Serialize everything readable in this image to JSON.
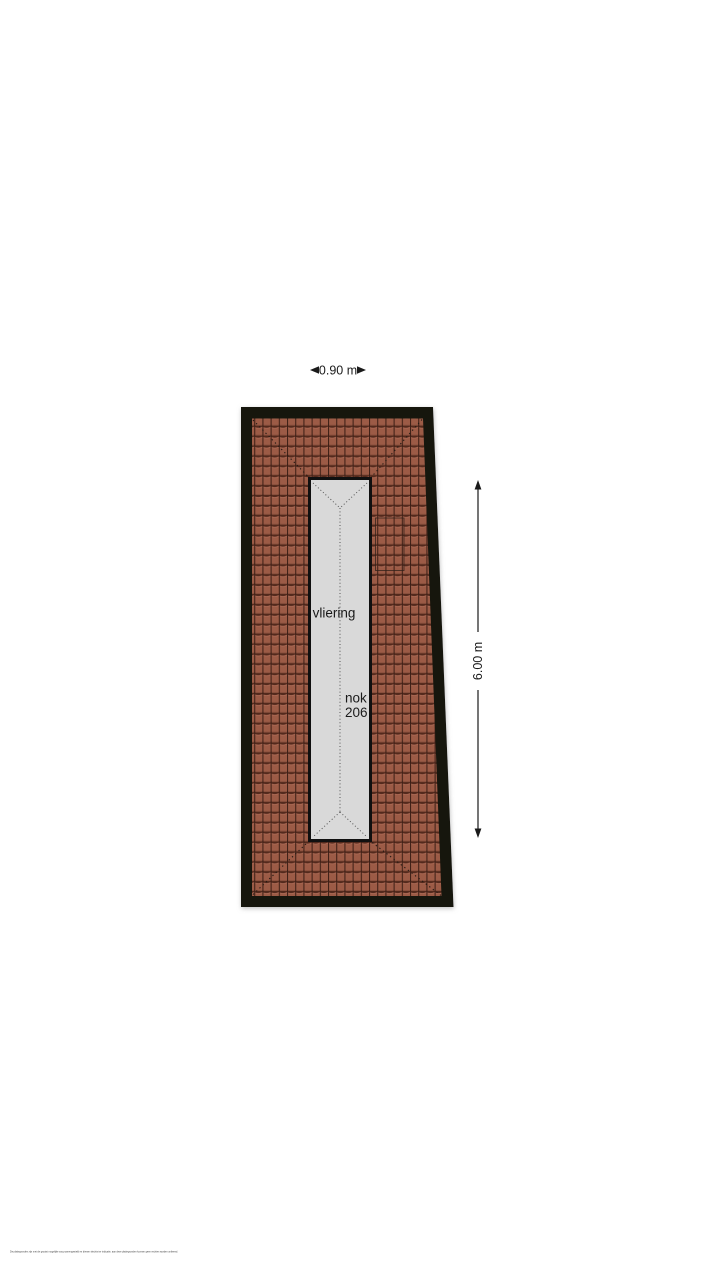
{
  "floorplan": {
    "attic_label": "vliering",
    "ridge_label": "nok",
    "ridge_height_value": "206",
    "width_dimension": "0.90 m",
    "height_dimension": "6.00 m"
  },
  "footer": {
    "disclaimer": "De plattegronden zijn met de grootst mogelijke zorg samengesteld en dienen slechts ter indicatie, aan deze plattegronden kunnen geen rechten worden ontleend."
  },
  "colors": {
    "page_background": "#ffffff",
    "roof_border": "#17120e",
    "tile_base": "#9c5b46",
    "tile_shadow": "#53291c",
    "tile_gap": "#3f2017",
    "tile_highlight": "#b4705a",
    "attic_fill": "#d9d9d9",
    "attic_border": "#101010",
    "dimension_color": "#1a1a1a",
    "footer_text": "#444444"
  }
}
